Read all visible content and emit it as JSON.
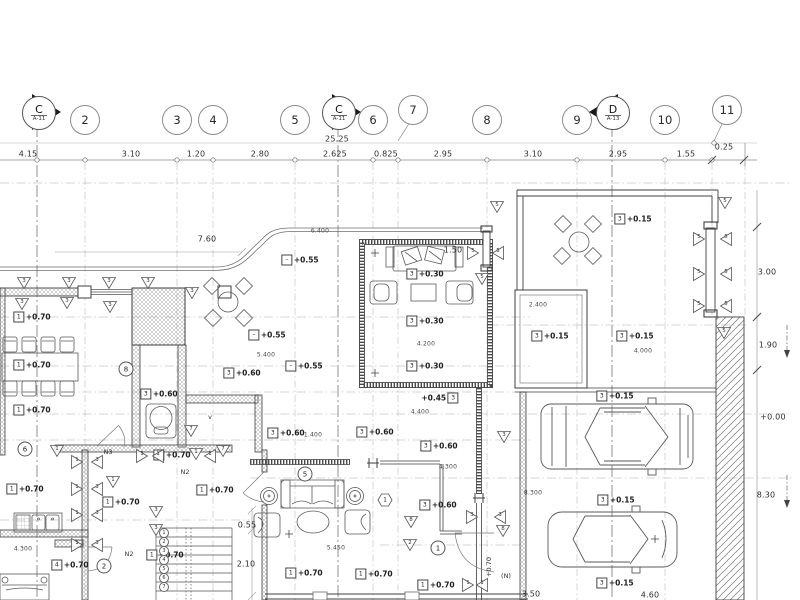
{
  "drawing": {
    "type": "architectural-floor-plan",
    "sheet_refs": [
      "A-11",
      "A-13"
    ]
  },
  "grid": {
    "bubbles": [
      {
        "label": "2",
        "x": 85,
        "y": 120
      },
      {
        "label": "3",
        "x": 177,
        "y": 120
      },
      {
        "label": "4",
        "x": 213,
        "y": 120
      },
      {
        "label": "5",
        "x": 295,
        "y": 120
      },
      {
        "label": "6",
        "x": 373,
        "y": 120
      },
      {
        "label": "7",
        "x": 413,
        "y": 110
      },
      {
        "label": "8",
        "x": 487,
        "y": 120
      },
      {
        "label": "9",
        "x": 577,
        "y": 120
      },
      {
        "label": "10",
        "x": 665,
        "y": 120
      },
      {
        "label": "11",
        "x": 727,
        "y": 110
      }
    ],
    "sections": [
      {
        "label": "C",
        "sheet": "A-11",
        "x": 38,
        "y": 112,
        "dir": "right"
      },
      {
        "label": "C",
        "sheet": "A-11",
        "x": 338,
        "y": 112,
        "dir": "right"
      },
      {
        "label": "D",
        "sheet": "A-13",
        "x": 612,
        "y": 112,
        "dir": "left"
      }
    ]
  },
  "dimensions": {
    "top_row": [
      {
        "text": "4.15",
        "x": 28,
        "y": 154
      },
      {
        "text": "3.10",
        "x": 131,
        "y": 154
      },
      {
        "text": "1.20",
        "x": 196,
        "y": 154
      },
      {
        "text": "2.80",
        "x": 260,
        "y": 154
      },
      {
        "text": "2.625",
        "x": 335,
        "y": 154
      },
      {
        "text": "0.825",
        "x": 386,
        "y": 154
      },
      {
        "text": "2.95",
        "x": 443,
        "y": 154
      },
      {
        "text": "3.10",
        "x": 533,
        "y": 154
      },
      {
        "text": "2.95",
        "x": 618,
        "y": 154
      },
      {
        "text": "1.55",
        "x": 686,
        "y": 154
      },
      {
        "text": "0.25",
        "x": 724,
        "y": 147
      },
      {
        "text": "25.25",
        "x": 337,
        "y": 139
      }
    ],
    "right_col": [
      {
        "text": "3.00",
        "x": 767,
        "y": 272
      },
      {
        "text": "1.90",
        "x": 768,
        "y": 345
      },
      {
        "text": "+0.00",
        "x": 773,
        "y": 417
      },
      {
        "text": "8.30",
        "x": 766,
        "y": 495
      }
    ],
    "interior": [
      {
        "text": "7.60",
        "x": 207,
        "y": 239
      },
      {
        "text": "1.50",
        "x": 453,
        "y": 250
      },
      {
        "text": "0.55",
        "x": 247,
        "y": 525
      },
      {
        "text": "2.10",
        "x": 246,
        "y": 564
      },
      {
        "text": "3.50",
        "x": 531,
        "y": 594
      },
      {
        "text": "4.60",
        "x": 650,
        "y": 595
      }
    ],
    "small": [
      {
        "text": "6.400",
        "x": 320,
        "y": 231
      },
      {
        "text": "5.400",
        "x": 266,
        "y": 355
      },
      {
        "text": "4.200",
        "x": 426,
        "y": 344
      },
      {
        "text": "4.400",
        "x": 420,
        "y": 412
      },
      {
        "text": "1.400",
        "x": 313,
        "y": 435
      },
      {
        "text": "2.400",
        "x": 538,
        "y": 305
      },
      {
        "text": "4.000",
        "x": 643,
        "y": 351
      },
      {
        "text": "4.300",
        "x": 23,
        "y": 549
      },
      {
        "text": "4.300",
        "x": 448,
        "y": 467
      },
      {
        "text": "5.450",
        "x": 336,
        "y": 548
      },
      {
        "text": "8.300",
        "x": 533,
        "y": 493
      }
    ]
  },
  "levels": [
    {
      "box": "1",
      "text": "+0.70",
      "x": 32,
      "y": 317
    },
    {
      "box": "1",
      "text": "+0.70",
      "x": 32,
      "y": 365
    },
    {
      "box": "1",
      "text": "+0.70",
      "x": 32,
      "y": 410
    },
    {
      "box": "1",
      "text": "+0.70",
      "x": 25,
      "y": 489
    },
    {
      "box": "1",
      "text": "+0.70",
      "x": 172,
      "y": 455
    },
    {
      "box": "1",
      "text": "+0.70",
      "x": 215,
      "y": 490
    },
    {
      "box": "1",
      "text": "+0.70",
      "x": 121,
      "y": 502
    },
    {
      "box": "1",
      "text": "+0.70",
      "x": 165,
      "y": 555
    },
    {
      "box": "4",
      "text": "+0.70",
      "x": 70,
      "y": 565
    },
    {
      "box": "1",
      "text": "+0.70",
      "x": 304,
      "y": 573
    },
    {
      "box": "1",
      "text": "+0.70",
      "x": 374,
      "y": 574
    },
    {
      "box": "1",
      "text": "+0.70",
      "x": 436,
      "y": 585
    },
    {
      "box": "3",
      "text": "+0.60",
      "x": 242,
      "y": 373
    },
    {
      "box": "3",
      "text": "+0.60",
      "x": 159,
      "y": 394
    },
    {
      "box": "3",
      "text": "+0.60",
      "x": 286,
      "y": 433
    },
    {
      "box": "3",
      "text": "+0.60",
      "x": 375,
      "y": 432
    },
    {
      "box": "3",
      "text": "+0.60",
      "x": 439,
      "y": 446
    },
    {
      "box": "3",
      "text": "+0.60",
      "x": 438,
      "y": 505
    },
    {
      "box": "–",
      "text": "+0.55",
      "x": 300,
      "y": 260
    },
    {
      "box": "–",
      "text": "+0.55",
      "x": 267,
      "y": 335
    },
    {
      "box": "–",
      "text": "+0.55",
      "x": 304,
      "y": 366
    },
    {
      "box": "3",
      "text": "+0.30",
      "x": 425,
      "y": 274
    },
    {
      "box": "3",
      "text": "+0.30",
      "x": 425,
      "y": 321
    },
    {
      "box": "3",
      "text": "+0.30",
      "x": 425,
      "y": 366
    },
    {
      "box": "3",
      "text": "+0.45",
      "x": 440,
      "y": 398,
      "boxside": "right"
    },
    {
      "box": "3",
      "text": "+0.15",
      "x": 633,
      "y": 219
    },
    {
      "box": "3",
      "text": "+0.15",
      "x": 550,
      "y": 336
    },
    {
      "box": "3",
      "text": "+0.15",
      "x": 635,
      "y": 336
    },
    {
      "box": "3",
      "text": "+0.15",
      "x": 615,
      "y": 396
    },
    {
      "box": "3",
      "text": "+0.15",
      "x": 616,
      "y": 500
    },
    {
      "box": "3",
      "text": "+0.15",
      "x": 615,
      "y": 583
    }
  ],
  "markers": {
    "triangles": [
      {
        "t": "3",
        "x": 24,
        "y": 283,
        "d": "down"
      },
      {
        "t": "3",
        "x": 69,
        "y": 283,
        "d": "down"
      },
      {
        "t": "3",
        "x": 109,
        "y": 283,
        "d": "down"
      },
      {
        "t": "3",
        "x": 148,
        "y": 283,
        "d": "down"
      },
      {
        "t": "3",
        "x": 192,
        "y": 293,
        "d": "down"
      },
      {
        "t": "3",
        "x": 22,
        "y": 304,
        "d": "down"
      },
      {
        "t": "3",
        "x": 67,
        "y": 303,
        "d": "down"
      },
      {
        "t": "3",
        "x": 110,
        "y": 307,
        "d": "down"
      },
      {
        "t": "1",
        "x": 57,
        "y": 451,
        "d": "down"
      },
      {
        "t": "1",
        "x": 77,
        "y": 462,
        "d": "right"
      },
      {
        "t": "3",
        "x": 97,
        "y": 462,
        "d": "left"
      },
      {
        "t": "1",
        "x": 77,
        "y": 489,
        "d": "right"
      },
      {
        "t": "3",
        "x": 97,
        "y": 489,
        "d": "left"
      },
      {
        "t": "1",
        "x": 77,
        "y": 515,
        "d": "right"
      },
      {
        "t": "3",
        "x": 97,
        "y": 515,
        "d": "left"
      },
      {
        "t": "1",
        "x": 77,
        "y": 545,
        "d": "right"
      },
      {
        "t": "3",
        "x": 97,
        "y": 545,
        "d": "left"
      },
      {
        "t": "1",
        "x": 113,
        "y": 482,
        "d": "down"
      },
      {
        "t": "3",
        "x": 156,
        "y": 512,
        "d": "down"
      },
      {
        "t": "3",
        "x": 156,
        "y": 530,
        "d": "down"
      },
      {
        "t": "7",
        "x": 191,
        "y": 431,
        "d": "down"
      },
      {
        "t": "1",
        "x": 142,
        "y": 456,
        "d": "right"
      },
      {
        "t": "1",
        "x": 158,
        "y": 456,
        "d": "left"
      },
      {
        "t": "1",
        "x": 196,
        "y": 454,
        "d": "down"
      },
      {
        "t": "1",
        "x": 210,
        "y": 456,
        "d": "left"
      },
      {
        "t": "7",
        "x": 223,
        "y": 451,
        "d": "down"
      },
      {
        "t": "5",
        "x": 473,
        "y": 253,
        "d": "right"
      },
      {
        "t": "5",
        "x": 498,
        "y": 253,
        "d": "left"
      },
      {
        "t": "5",
        "x": 482,
        "y": 279,
        "d": "down"
      },
      {
        "t": "5",
        "x": 497,
        "y": 207,
        "d": "down"
      },
      {
        "t": "5",
        "x": 725,
        "y": 203,
        "d": "down"
      },
      {
        "t": "5",
        "x": 699,
        "y": 239,
        "d": "right"
      },
      {
        "t": "5",
        "x": 726,
        "y": 239,
        "d": "left"
      },
      {
        "t": "5",
        "x": 699,
        "y": 274,
        "d": "right"
      },
      {
        "t": "5",
        "x": 726,
        "y": 274,
        "d": "left"
      },
      {
        "t": "5",
        "x": 699,
        "y": 306,
        "d": "right"
      },
      {
        "t": "5",
        "x": 726,
        "y": 306,
        "d": "left"
      },
      {
        "t": "5",
        "x": 724,
        "y": 333,
        "d": "down"
      },
      {
        "t": "8",
        "x": 411,
        "y": 522,
        "d": "down"
      },
      {
        "t": "2",
        "x": 410,
        "y": 545,
        "d": "down"
      },
      {
        "t": "3",
        "x": 472,
        "y": 517,
        "d": "right"
      },
      {
        "t": "3",
        "x": 500,
        "y": 517,
        "d": "left"
      },
      {
        "t": "8",
        "x": 503,
        "y": 531,
        "d": "down"
      },
      {
        "t": "3",
        "x": 504,
        "y": 437,
        "d": "down"
      },
      {
        "t": "1",
        "x": 468,
        "y": 585,
        "d": "right"
      },
      {
        "t": "1",
        "x": 482,
        "y": 585,
        "d": "left"
      }
    ],
    "circles": [
      {
        "t": "8",
        "x": 126,
        "y": 369
      },
      {
        "t": "6",
        "x": 25,
        "y": 449
      },
      {
        "t": "5",
        "x": 305,
        "y": 474
      },
      {
        "t": "1",
        "x": 438,
        "y": 548
      },
      {
        "t": "2",
        "x": 104,
        "y": 566
      }
    ],
    "hexagons": [
      {
        "t": "1",
        "x": 385,
        "y": 500
      }
    ],
    "texts": [
      {
        "text": "N3",
        "x": 108,
        "y": 452
      },
      {
        "text": "N2",
        "x": 185,
        "y": 472
      },
      {
        "text": "N2",
        "x": 129,
        "y": 554
      },
      {
        "text": "(N)",
        "x": 506,
        "y": 576
      },
      {
        "text": "+0.70",
        "x": 489,
        "y": 567,
        "rot": -90
      },
      {
        "text": "v",
        "x": 210,
        "y": 417
      }
    ]
  },
  "stairs": {
    "x": 164,
    "y_start": 532.5,
    "step": 9,
    "labels": [
      "1",
      "2",
      "3",
      "4",
      "5",
      "6",
      "7"
    ]
  }
}
